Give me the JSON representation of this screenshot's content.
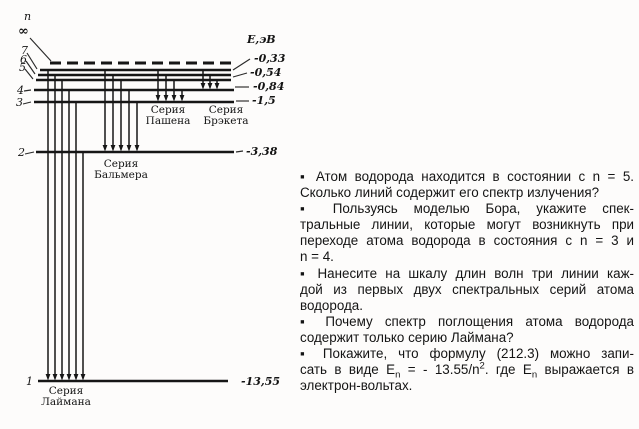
{
  "diagram": {
    "n_label": {
      "text": "n",
      "x": 24,
      "y": 20
    },
    "energy_header": {
      "text": "E,эВ",
      "x": 247,
      "y": 43
    },
    "levels": [
      {
        "n": "∞",
        "y": 63,
        "x1": 50,
        "x2": 231,
        "dashed": true,
        "lx": 18,
        "ly": 35,
        "ptr": [
          30,
          38,
          51,
          61
        ]
      },
      {
        "n": "7",
        "y": 70,
        "x1": 40,
        "x2": 231,
        "lx": 21,
        "ly": 54,
        "ptr": [
          27,
          53,
          37,
          69
        ]
      },
      {
        "n": "6",
        "y": 75,
        "x1": 38,
        "x2": 231,
        "lx": 20,
        "ly": 63,
        "ptr": [
          26,
          61,
          35,
          74
        ]
      },
      {
        "n": "5",
        "y": 80,
        "x1": 36,
        "x2": 231,
        "lx": 19,
        "ly": 71,
        "ptr": [
          25,
          69,
          33,
          79
        ]
      },
      {
        "n": "4",
        "y": 90,
        "x1": 34,
        "x2": 234,
        "lx": 17,
        "ly": 94,
        "ptr": [
          24,
          91,
          31,
          90
        ]
      },
      {
        "n": "3",
        "y": 102,
        "x1": 34,
        "x2": 234,
        "lx": 16,
        "ly": 106,
        "ptr": [
          23,
          104,
          31,
          102
        ]
      },
      {
        "n": "2",
        "y": 152,
        "x1": 36,
        "x2": 234,
        "lx": 18,
        "ly": 156,
        "ptr": [
          25,
          154,
          34,
          152
        ]
      },
      {
        "n": "1",
        "y": 381,
        "x1": 38,
        "x2": 228,
        "lx": 26,
        "ly": 385,
        "ptr": null
      }
    ],
    "energies": [
      {
        "label": "-0,33",
        "x": 254,
        "y": 62,
        "ptr": [
          233,
          70,
          250,
          59
        ]
      },
      {
        "label": "-0,54",
        "x": 250,
        "y": 76,
        "ptr": [
          233,
          77,
          247,
          73
        ]
      },
      {
        "label": "-0,84",
        "x": 253,
        "y": 90,
        "ptr": [
          235,
          87,
          249,
          87
        ]
      },
      {
        "label": "-1,5",
        "x": 252,
        "y": 104,
        "ptr": [
          236,
          101,
          249,
          101
        ]
      },
      {
        "label": "-3,38",
        "x": 246,
        "y": 155,
        "ptr": [
          236,
          152,
          243,
          151
        ]
      },
      {
        "label": "-13,55",
        "x": 241,
        "y": 385,
        "ptr": null
      }
    ],
    "series": [
      {
        "key": "lyman",
        "label1": "Серия",
        "label2": "Лаймана",
        "cx": 66,
        "ty": 394,
        "ty2": 405,
        "end_y": 381,
        "arrows": [
          [
            48,
            70
          ],
          [
            55,
            75
          ],
          [
            62,
            80
          ],
          [
            69,
            90
          ],
          [
            76,
            102
          ],
          [
            83,
            152
          ]
        ]
      },
      {
        "key": "balmer",
        "label1": "Серия",
        "label2": "Бальмера",
        "cx": 121,
        "ty": 167,
        "ty2": 178,
        "end_y": 152,
        "arrows": [
          [
            105,
            70
          ],
          [
            113,
            75
          ],
          [
            121,
            80
          ],
          [
            129,
            90
          ],
          [
            137,
            102
          ]
        ]
      },
      {
        "key": "paschen",
        "label1": "Серия",
        "label2": "Пашена",
        "cx": 168,
        "ty": 113,
        "ty2": 124,
        "end_y": 102,
        "arrows": [
          [
            158,
            70
          ],
          [
            166,
            75
          ],
          [
            174,
            80
          ],
          [
            182,
            90
          ]
        ]
      },
      {
        "key": "brackett",
        "label1": "Серия",
        "label2": "Брэкета",
        "cx": 226,
        "ty": 113,
        "ty2": 124,
        "end_y": 90,
        "arrows": [
          [
            203,
            70
          ],
          [
            210,
            75
          ],
          [
            217,
            80
          ]
        ]
      }
    ]
  },
  "questions": {
    "lines": [
      "▪  Атом водорода находится в состоянии с n = 5.",
      "Сколько линий содержит его спектр излучения?",
      "▪  Пользуясь  моделью  Бора,  укажите  спек-",
      "тральные линии, которые могут возникнуть при",
      "переходе атома водорода в состояния с n = 3 и",
      "n = 4.",
      "▪  Нанесите на шкалу длин волн три линии каж-",
      "дой из первых двух спектральных серий атома",
      "водорода.",
      "▪  Почему спектр поглощения атома водорода",
      "содержит только серию Лаймана?",
      "▪  Покажите, что формулу (212.3) можно запи-",
      "электрон-вольтах."
    ],
    "eq": {
      "pre": "сать в виде E",
      "sub1": "n",
      "mid": " = - 13.55/n",
      "sup1": "2",
      "post1": ". где E",
      "sub2": "n",
      "post2": " выражается в"
    }
  }
}
